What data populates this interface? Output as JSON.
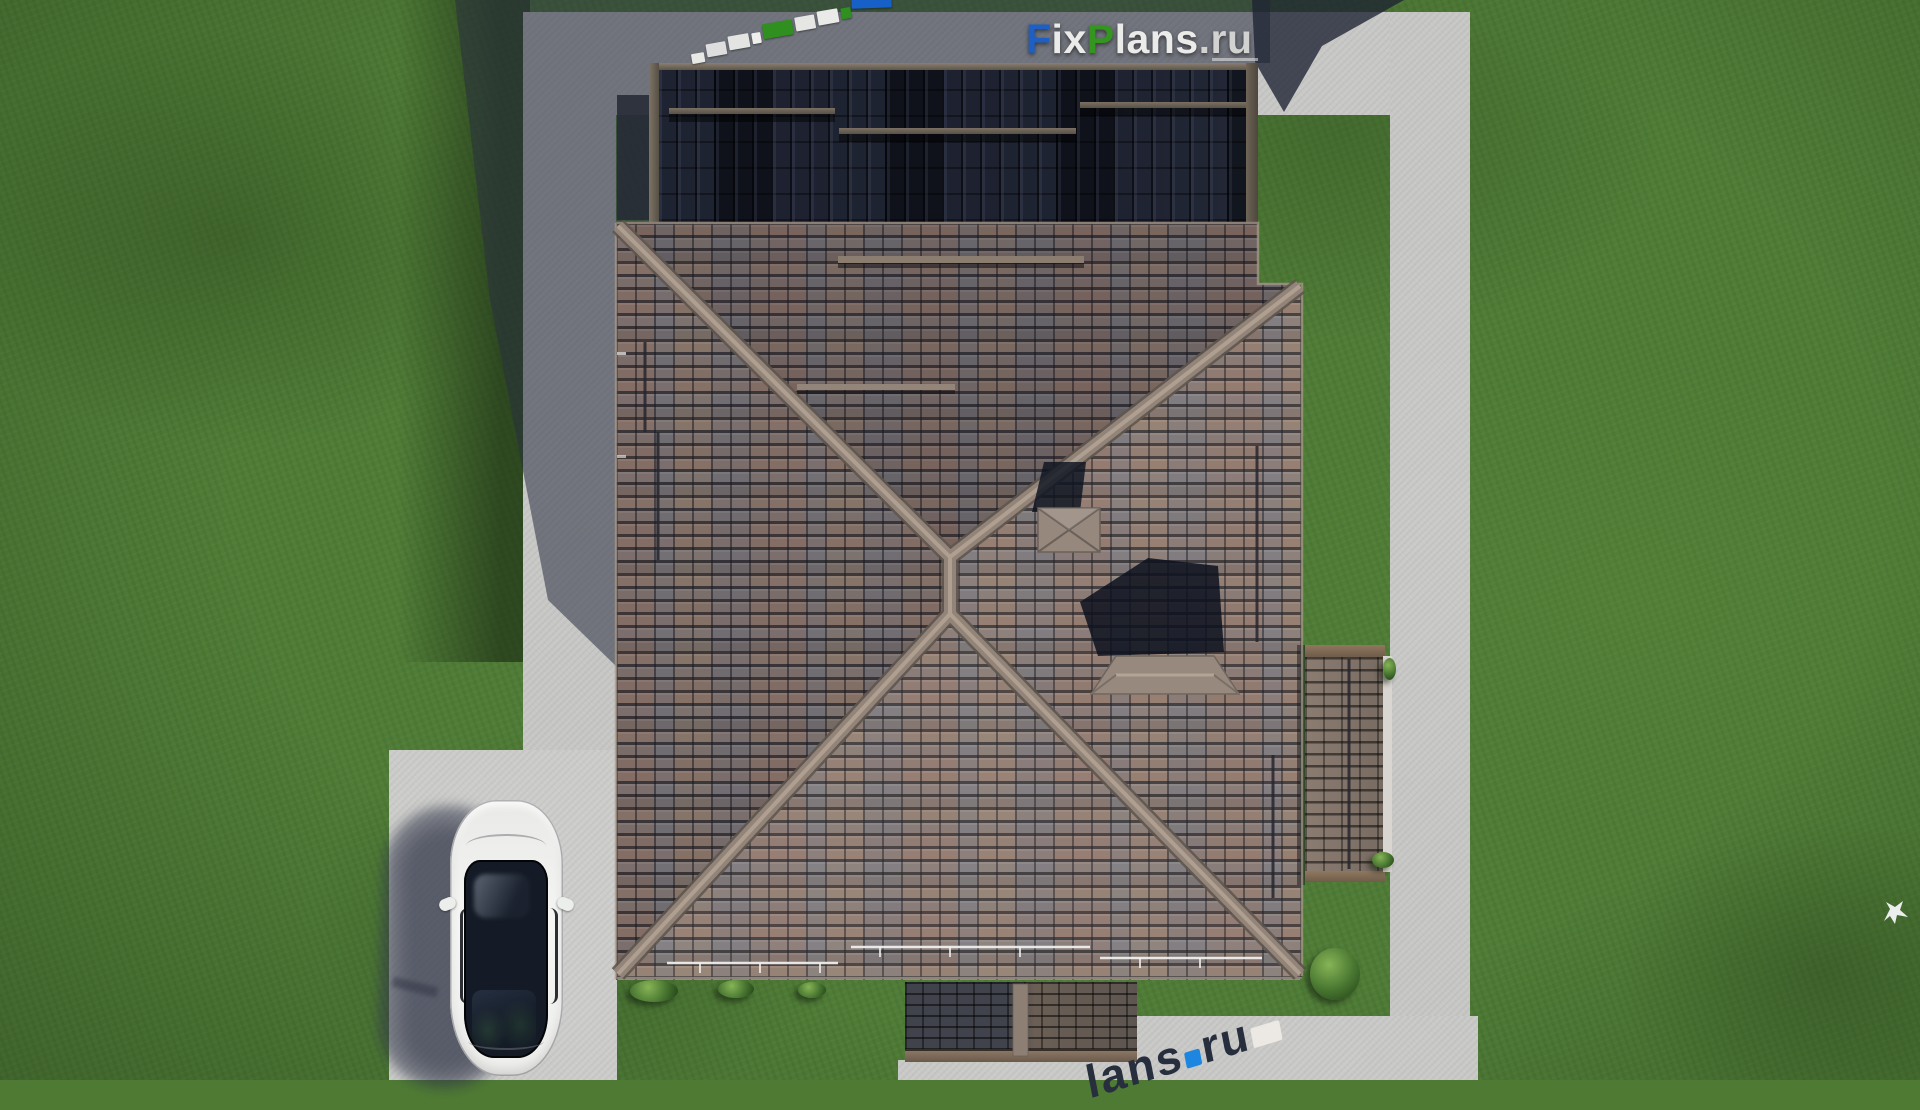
{
  "scene": {
    "description": "Aerial top-down 3D render of a hip-roof house with brown-gray tiled roof, a dark shadowed upper roof section, concrete walkways around the lawn, a white sedan parked on the driveway and a white bird on the grass",
    "objects": [
      "lawn-grass",
      "concrete-path",
      "driveway",
      "main-hip-roof",
      "upper-roof-shadowed",
      "terrace-roof",
      "porch-roof",
      "roof-vent-cap",
      "chimney-cap",
      "white-car",
      "bushes",
      "bird"
    ]
  },
  "logo": {
    "text": "FixPlans.ru",
    "segments": [
      {
        "text": "F",
        "color": "#1d5fc4"
      },
      {
        "text": "ix",
        "color": "#ebebe9"
      },
      {
        "text": "P",
        "color": "#34951f"
      },
      {
        "text": "lans",
        "color": "#ebebe9"
      },
      {
        "text": ".ru",
        "color": "#d2d2d0"
      }
    ]
  },
  "distorted_top_watermark": {
    "note": "perspective-distorted FixPlans.ru watermark blocks on dark roof",
    "blocks": [
      {
        "w": 13,
        "h": 10,
        "color": "#e8e8e4",
        "dy": 18
      },
      {
        "w": 20,
        "h": 13,
        "color": "#dedede",
        "dy": 14
      },
      {
        "w": 21,
        "h": 14,
        "color": "#e4e4e2",
        "dy": 11
      },
      {
        "w": 9,
        "h": 11,
        "color": "#eeeeec",
        "dy": 9
      },
      {
        "w": 30,
        "h": 15,
        "color": "#2f8f1f",
        "dy": 6
      },
      {
        "w": 20,
        "h": 14,
        "color": "#e6e6e4",
        "dy": 4
      },
      {
        "w": 21,
        "h": 14,
        "color": "#eaeae8",
        "dy": 2
      },
      {
        "w": 10,
        "h": 11,
        "color": "#2f8f1f",
        "dy": 0
      },
      {
        "w": 40,
        "h": 26,
        "color": "#1660c8",
        "dy": -6
      }
    ]
  },
  "distorted_bottom_watermark": {
    "note": "perspective-distorted watermark at bottom edge, partially cut off",
    "letter_color": "#272e3d",
    "items": [
      {
        "type": "letter",
        "text": "l"
      },
      {
        "type": "letter",
        "text": "a"
      },
      {
        "type": "letter",
        "text": "n"
      },
      {
        "type": "letter",
        "text": "s"
      },
      {
        "type": "block",
        "color": "#1d86e0",
        "w": 16,
        "h": 16
      },
      {
        "type": "letter",
        "text": "r"
      },
      {
        "type": "letter",
        "text": "u"
      },
      {
        "type": "block",
        "color": "#ece9e4",
        "w": 30,
        "h": 20
      }
    ]
  },
  "palette": {
    "grass": "#4f7c36",
    "path": "#c7c7c5",
    "roof_tiles_brown": "#9a7f74",
    "roof_tiles_gray": "#82838a",
    "ridge_cap": "#93847a",
    "dark_roof": "#151823",
    "shadow_slate": "#2a3040",
    "car_body": "#f2f2f0",
    "car_glass": "#141b27",
    "logo_blue": "#1d5fc4",
    "logo_green": "#34951f"
  }
}
